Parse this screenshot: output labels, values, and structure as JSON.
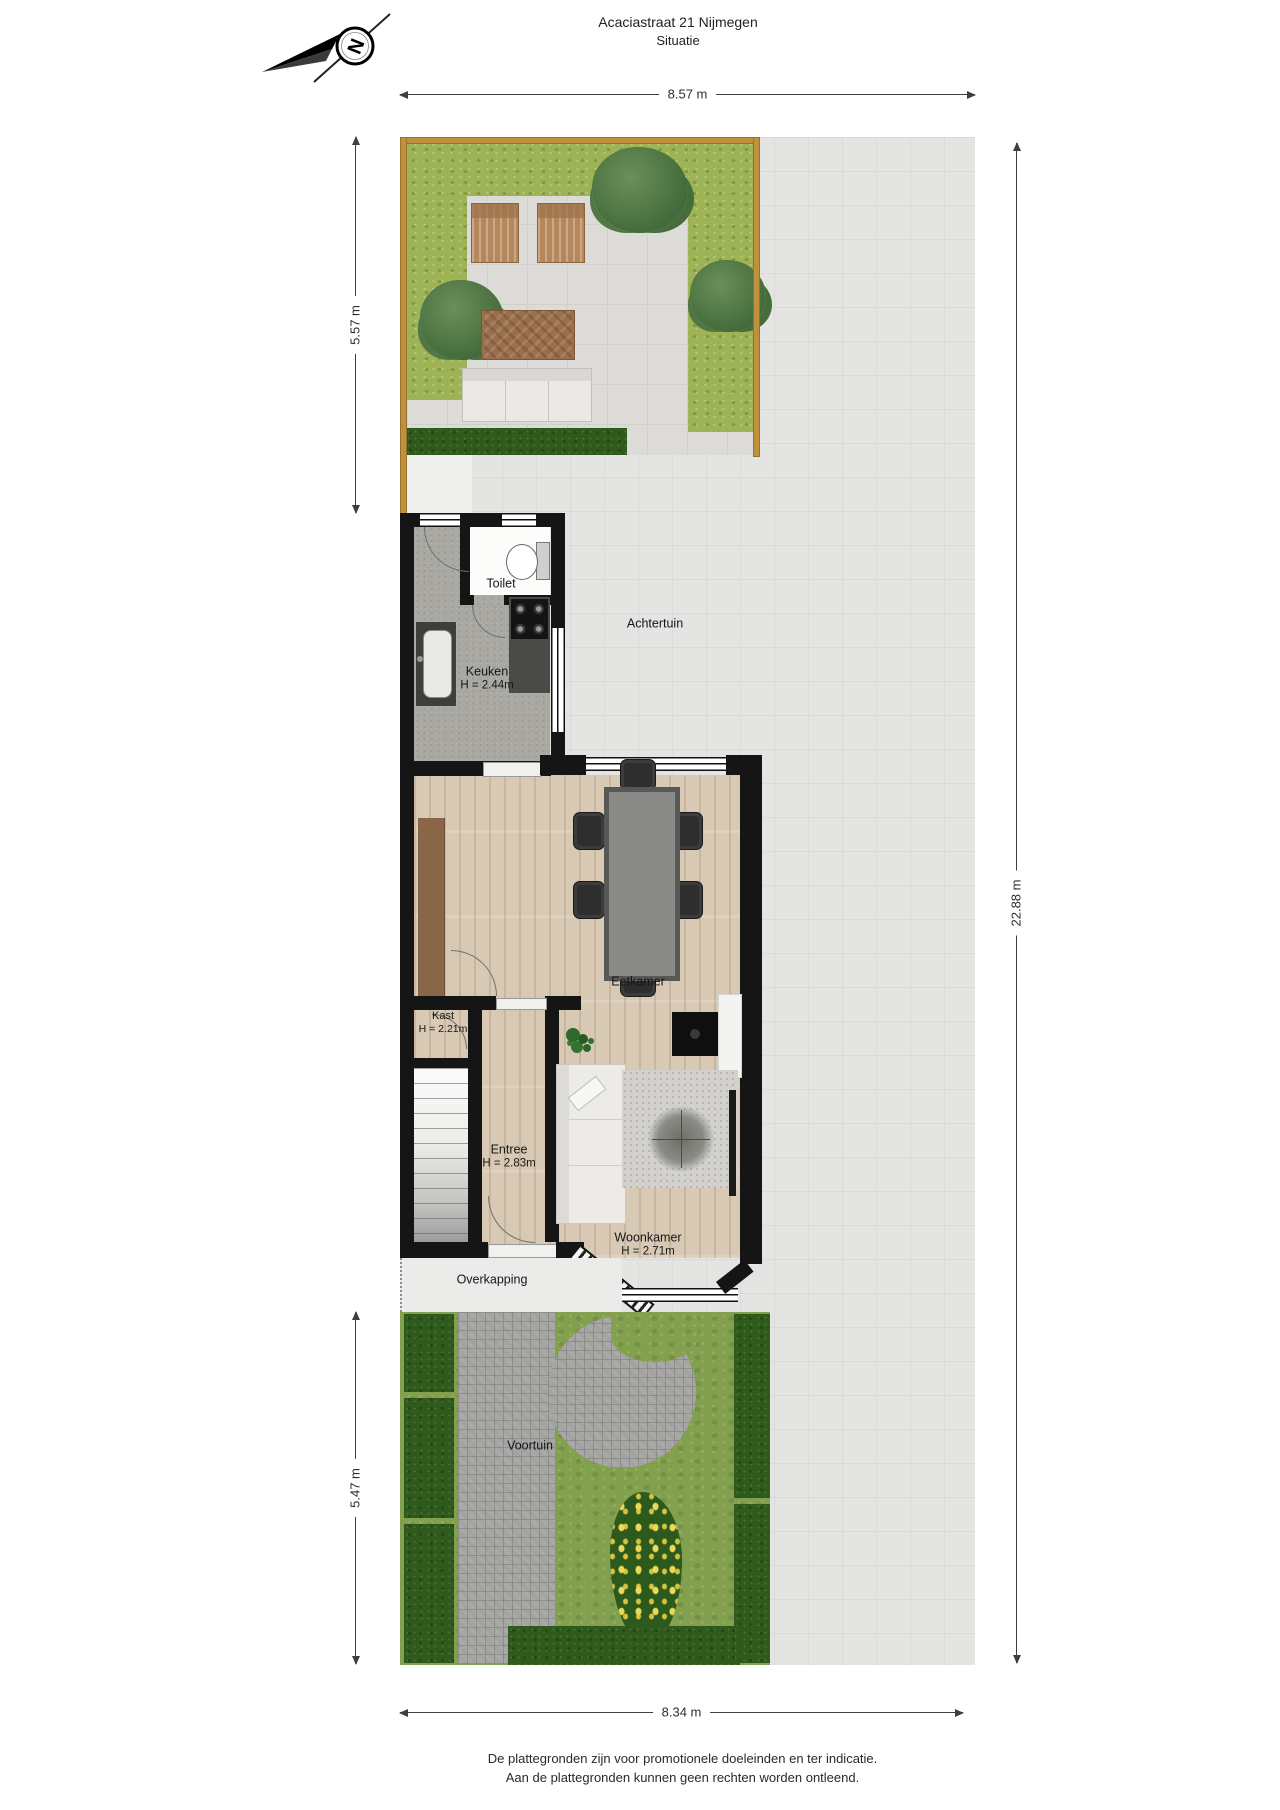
{
  "header": {
    "title": "Acaciastraat 21 Nijmegen",
    "subtitle": "Situatie"
  },
  "compass": {
    "letter": "N"
  },
  "dimensions": {
    "plot_width_top": "8.57 m",
    "back_garden_depth": "5.57 m",
    "plot_depth": "22.88 m",
    "front_garden_depth": "5.47 m",
    "plot_width_bottom": "8.34 m"
  },
  "rooms": {
    "achtertuin": {
      "label": "Achtertuin"
    },
    "toilet": {
      "label": "Toilet"
    },
    "keuken": {
      "label": "Keuken",
      "ceiling": "H = 2.44m"
    },
    "eetkamer": {
      "label": "Eetkamer"
    },
    "kast": {
      "label": "Kast",
      "ceiling": "H = 2.21m"
    },
    "entree": {
      "label": "Entree",
      "ceiling": "H = 2.83m"
    },
    "woonkamer": {
      "label": "Woonkamer",
      "ceiling": "H = 2.71m"
    },
    "overkapping": {
      "label": "Overkapping"
    },
    "voortuin": {
      "label": "Voortuin"
    }
  },
  "footer": {
    "line1": "De plattegronden zijn voor promotionele doeleinden en ter indicatie.",
    "line2": "Aan de plattegronden kunnen geen rechten worden ontleend."
  },
  "colors": {
    "wall": "#151515",
    "fence": "#c0913c",
    "tile": "#e4e4e3",
    "hedge_light": "#9db356",
    "hedge_dark": "#30591d",
    "grass": "#83a04e",
    "wood_floor": "#d8c9b4",
    "kitchen_floor": "#a9a8a2",
    "brick_path": "#a3a3a1"
  }
}
